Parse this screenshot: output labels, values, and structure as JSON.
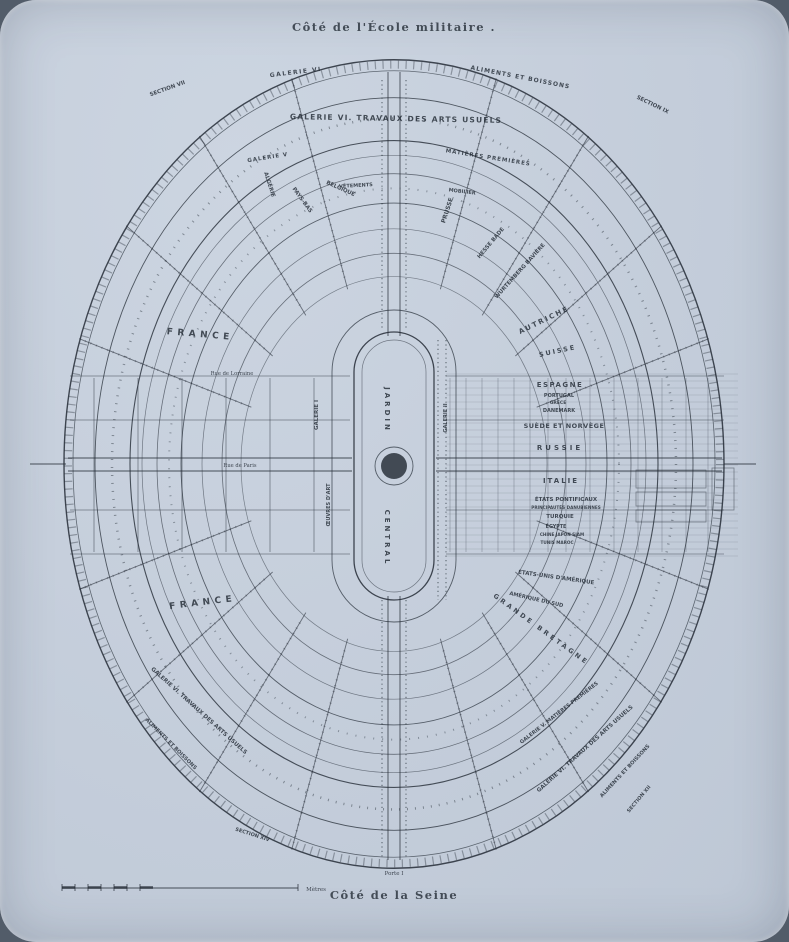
{
  "captions": {
    "top": "Côté de l'École militaire .",
    "bottom": "Côté de la Seine"
  },
  "colors": {
    "ink": "#242c36",
    "paper": "#c6cfdc"
  },
  "map": {
    "labels": [
      {
        "id": "jardin",
        "t": "JARDIN",
        "x": 385,
        "y": 410,
        "r": 90,
        "s": 7,
        "ls": 3,
        "b": 1
      },
      {
        "id": "central",
        "t": "CENTRAL",
        "x": 385,
        "y": 538,
        "r": 90,
        "s": 7,
        "ls": 3,
        "b": 1
      },
      {
        "id": "arc-galerie-vi",
        "t": "GALERIE VI",
        "x": 296,
        "y": 74,
        "r": -7,
        "s": 6,
        "ls": 1.5,
        "b": 1
      },
      {
        "id": "arc-section-vii",
        "t": "SECTION VII",
        "x": 168,
        "y": 90,
        "r": -20,
        "s": 5.5
      },
      {
        "id": "arc-aliments-n",
        "t": "ALIMENTS ET BOISSONS",
        "x": 520,
        "y": 79,
        "r": 11,
        "s": 6,
        "ls": 1,
        "b": 1
      },
      {
        "id": "arc-section-ix",
        "t": "SECTION IX",
        "x": 652,
        "y": 106,
        "r": 26,
        "s": 5.5
      },
      {
        "id": "arc-travaux-n",
        "t": "GALERIE VI. TRAVAUX DES ARTS USUELS",
        "x": 396,
        "y": 121,
        "r": 1,
        "s": 7.5,
        "ls": 1.2,
        "b": 1
      },
      {
        "id": "arc-galerie-v",
        "t": "GALERIE V",
        "x": 268,
        "y": 159,
        "r": -9,
        "s": 5.5,
        "ls": 1
      },
      {
        "id": "arc-matieres",
        "t": "MATIÈRES PREMIÈRES",
        "x": 488,
        "y": 159,
        "r": 9,
        "s": 5.5,
        "ls": 1
      },
      {
        "id": "arc-vetements",
        "t": "VÊTEMENTS",
        "x": 356,
        "y": 187,
        "r": -3,
        "s": 5
      },
      {
        "id": "arc-mobilier",
        "t": "MOBILIER",
        "x": 462,
        "y": 193,
        "r": 7,
        "s": 5
      },
      {
        "id": "galerie-i",
        "t": "GALERIE I",
        "x": 318,
        "y": 415,
        "r": -90,
        "s": 5.5
      },
      {
        "id": "oeuvres-dart",
        "t": "ŒUVRES D'ART",
        "x": 330,
        "y": 505,
        "r": -90,
        "s": 5
      },
      {
        "id": "galerie-ii",
        "t": "GALERIE II",
        "x": 447,
        "y": 418,
        "r": -90,
        "s": 5
      },
      {
        "id": "france-nord",
        "t": "FRANCE",
        "x": 200,
        "y": 337,
        "r": 5,
        "s": 9,
        "ls": 4.5,
        "b": 1
      },
      {
        "id": "algerie",
        "t": "ALGÉRIE",
        "x": 268,
        "y": 185,
        "r": 72,
        "s": 5.5
      },
      {
        "id": "pays-bas",
        "t": "PAYS-BAS",
        "x": 301,
        "y": 201,
        "r": 54,
        "s": 5.5
      },
      {
        "id": "belgique",
        "t": "BELGIQUE",
        "x": 340,
        "y": 190,
        "r": 24,
        "s": 5.5
      },
      {
        "id": "prusse",
        "t": "PRUSSE",
        "x": 449,
        "y": 211,
        "r": -72,
        "s": 6
      },
      {
        "id": "hesse-bade",
        "t": "HESSE BADE",
        "x": 492,
        "y": 244,
        "r": -50,
        "s": 5.5
      },
      {
        "id": "wurtemberg-baviere",
        "t": "WURTEMBERG BAVIÈRE",
        "x": 521,
        "y": 272,
        "r": -48,
        "s": 5.5
      },
      {
        "id": "autriche",
        "t": "AUTRICHE",
        "x": 545,
        "y": 322,
        "r": -26,
        "s": 7,
        "ls": 2,
        "b": 1
      },
      {
        "id": "suisse",
        "t": "SUISSE",
        "x": 558,
        "y": 353,
        "r": -12,
        "s": 6.5,
        "ls": 2,
        "b": 1
      },
      {
        "id": "espagne",
        "t": "ESPAGNE",
        "x": 560,
        "y": 387,
        "r": 0,
        "s": 7,
        "ls": 1.5,
        "b": 1
      },
      {
        "id": "portugal",
        "t": "PORTUGAL",
        "x": 559,
        "y": 397,
        "r": 0,
        "s": 5
      },
      {
        "id": "grece",
        "t": "GRÈCE",
        "x": 558,
        "y": 404,
        "r": 0,
        "s": 4.5
      },
      {
        "id": "danemark",
        "t": "DANEMARK",
        "x": 559,
        "y": 412,
        "r": 0,
        "s": 5
      },
      {
        "id": "suede-norvege",
        "t": "SUÈDE ET NORVÈGE",
        "x": 564,
        "y": 428,
        "r": 0,
        "s": 6.5,
        "ls": 0.5,
        "b": 1
      },
      {
        "id": "russie",
        "t": "RUSSIE",
        "x": 560,
        "y": 450,
        "r": 0,
        "s": 7,
        "ls": 3,
        "b": 1
      },
      {
        "id": "italie",
        "t": "ITALIE",
        "x": 561,
        "y": 483,
        "r": 0,
        "s": 7,
        "ls": 2,
        "b": 1
      },
      {
        "id": "etats-pontificaux",
        "t": "ÉTATS PONTIFICAUX",
        "x": 566,
        "y": 501,
        "r": 0,
        "s": 5.5
      },
      {
        "id": "principautes-danubiennes",
        "t": "PRINCIPAUTÉS DANUBIENNES",
        "x": 566,
        "y": 509,
        "r": 0,
        "s": 4.2
      },
      {
        "id": "turquie",
        "t": "TURQUIE",
        "x": 560,
        "y": 518,
        "r": 0,
        "s": 5.5
      },
      {
        "id": "egypte",
        "t": "ÉGYPTE",
        "x": 556,
        "y": 528,
        "r": 0,
        "s": 4.8
      },
      {
        "id": "chine-japon-siam",
        "t": "CHINE JAPON SIAM",
        "x": 562,
        "y": 536,
        "r": 0,
        "s": 4.2
      },
      {
        "id": "tunis-maroc",
        "t": "TUNIS MAROC",
        "x": 557,
        "y": 544,
        "r": 0,
        "s": 4.2
      },
      {
        "id": "etats-unis",
        "t": "ÉTATS-UNIS D'AMÉRIQUE",
        "x": 556,
        "y": 579,
        "r": 8,
        "s": 5.5
      },
      {
        "id": "amerique-du-sud",
        "t": "AMÉRIQUE DU SUD",
        "x": 536,
        "y": 601,
        "r": 13,
        "s": 5.2
      },
      {
        "id": "grande-bretagne",
        "t": "GRANDE BRETAGNE",
        "x": 540,
        "y": 631,
        "r": 36,
        "s": 6.5,
        "ls": 3,
        "b": 1
      },
      {
        "id": "france-sud",
        "t": "FRANCE",
        "x": 203,
        "y": 605,
        "r": -7,
        "s": 9,
        "ls": 4.5,
        "b": 1
      },
      {
        "id": "rue-de-lorraine",
        "t": "Rue de Lorraine",
        "x": 232,
        "y": 375,
        "r": 0,
        "s": 5.2,
        "f": "serif"
      },
      {
        "id": "rue-de-paris",
        "t": "Rue de Paris",
        "x": 240,
        "y": 467,
        "r": 0,
        "s": 5.2,
        "f": "serif"
      },
      {
        "id": "arc-travaux-sw",
        "t": "GALERIE VI. TRAVAUX DES ARTS USUELS",
        "x": 198,
        "y": 712,
        "r": 42,
        "s": 5.6,
        "b": 1
      },
      {
        "id": "arc-aliments-sw",
        "t": "ALIMENTS ET BOISSONS",
        "x": 170,
        "y": 745,
        "r": 45,
        "s": 5.2
      },
      {
        "id": "arc-section-sw",
        "t": "SECTION XIV",
        "x": 252,
        "y": 836,
        "r": 18,
        "s": 5
      },
      {
        "id": "arc-galv-se",
        "t": "GALERIE V. MATIÈRES PREMIÈRES",
        "x": 560,
        "y": 714,
        "r": -38,
        "s": 5.2
      },
      {
        "id": "arc-travaux-se",
        "t": "GALERIE VI. TRAVAUX DES ARTS USUELS",
        "x": 586,
        "y": 750,
        "r": -42,
        "s": 5.6,
        "b": 1
      },
      {
        "id": "arc-aliments-se",
        "t": "ALIMENTS ET BOISSONS",
        "x": 626,
        "y": 772,
        "r": -47,
        "s": 5.2
      },
      {
        "id": "arc-section-se",
        "t": "SECTION XII",
        "x": 640,
        "y": 800,
        "r": -50,
        "s": 5
      },
      {
        "id": "porte-i",
        "t": "Porte I",
        "x": 394,
        "y": 875,
        "r": 0,
        "s": 5.5,
        "f": "serif"
      },
      {
        "id": "scale-metres",
        "t": "Mètres",
        "x": 316,
        "y": 891,
        "r": 0,
        "s": 5.5,
        "f": "serif"
      }
    ]
  }
}
